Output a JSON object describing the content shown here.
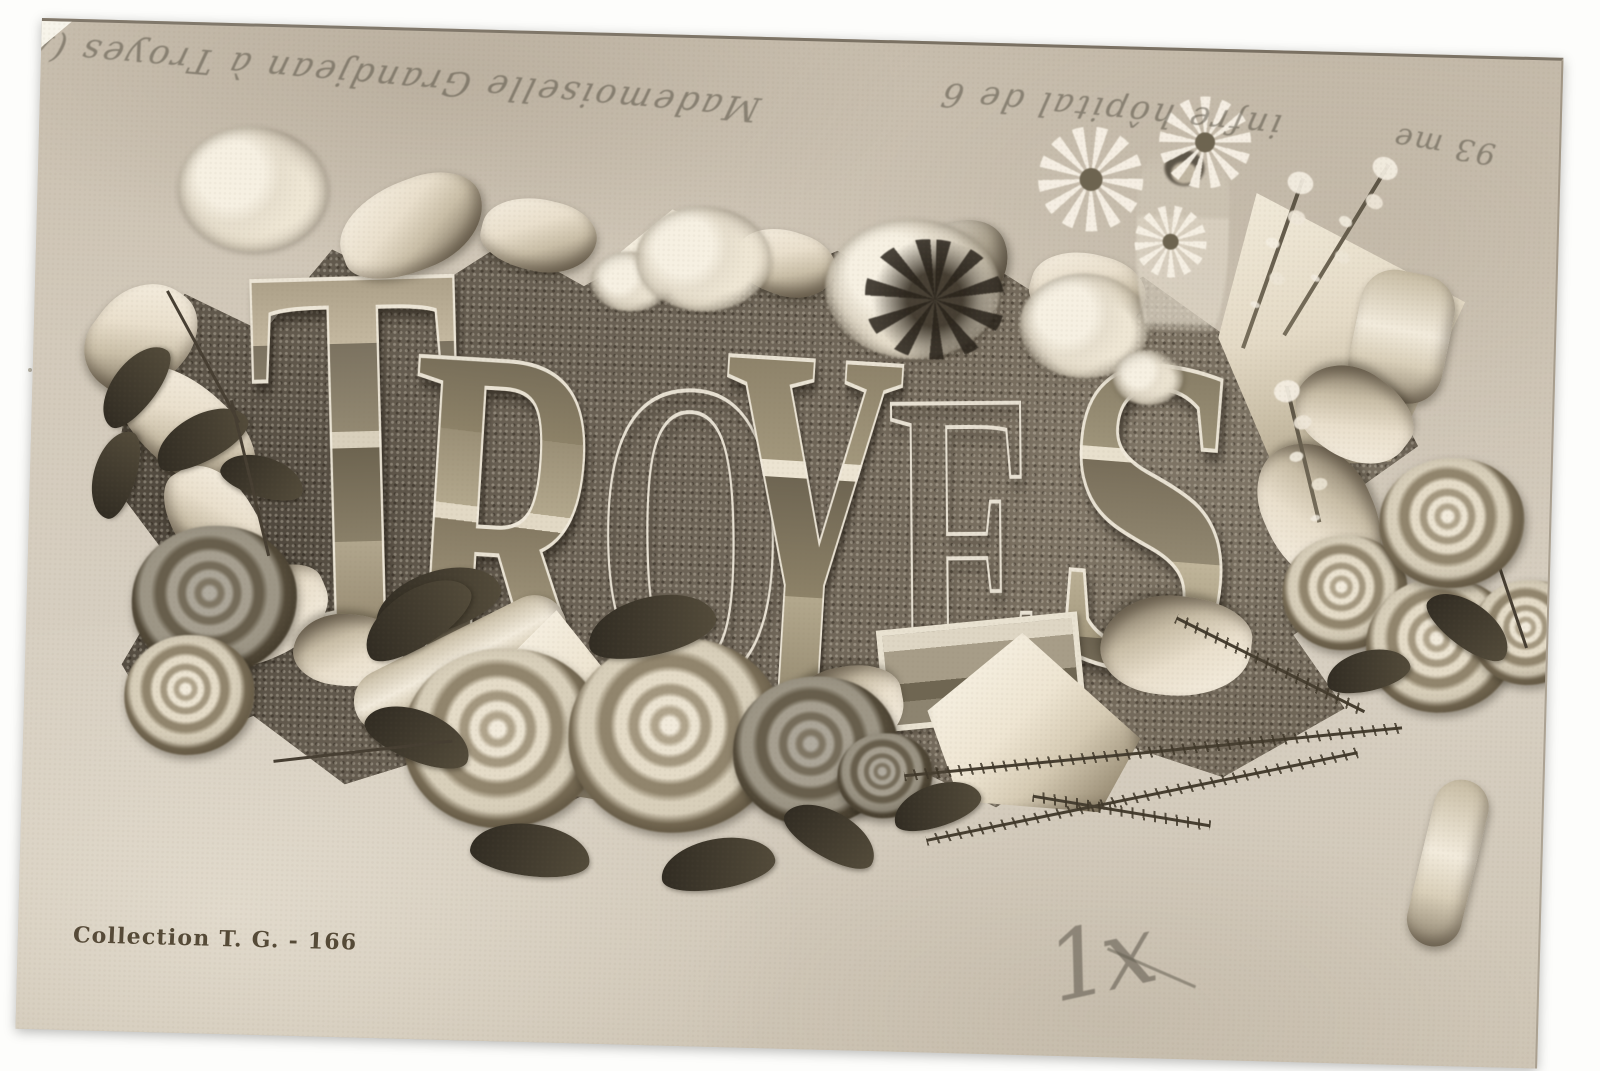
{
  "postcard": {
    "city_word": {
      "letters": [
        {
          "char": "T",
          "vignette": "carved frieze and ornate wrought-iron gate"
        },
        {
          "char": "R",
          "vignette": "market arcade, chateau towers, fountain and town square"
        },
        {
          "char": "O",
          "vignette": "theatre facade and hotel de ville with domed turret"
        },
        {
          "char": "Y",
          "vignette": "half-timbered lane, church spire and monument column"
        },
        {
          "char": "E",
          "vignette": "church portal, cathedral towers and long palace front"
        },
        {
          "char": "S",
          "vignette": "rooftop panorama, grand building and square with tram"
        }
      ]
    },
    "publisher_caption": "Collection T. G. - 166",
    "pencil_mark": "1x",
    "handwriting": {
      "left_line": "Mademoiselle Grandjean à Troyes (Aube)",
      "right_line": "infre hôpital de 6",
      "number_note": "93 me"
    },
    "colors": {
      "scan_background": "#fdfdfb",
      "card_paper": "#d0c7b8",
      "torn_leather_center": "#6b6254",
      "paper_curl": "#f3ecdd",
      "printed_ink": "#473b28",
      "pencil": "#565044"
    }
  }
}
